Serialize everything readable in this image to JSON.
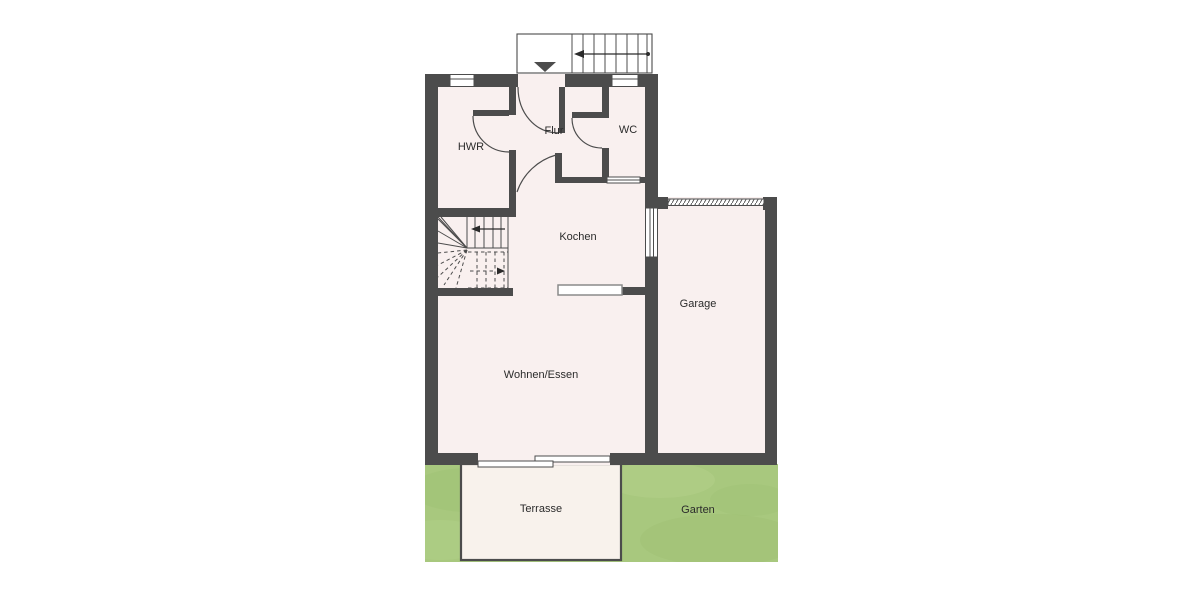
{
  "plan": {
    "type": "floor-plan",
    "colors": {
      "wall": "#4c4c4c",
      "floor": "#f9f0ef",
      "terrace": "#f8f2ec",
      "garden": "#a8c87e",
      "background": "#ffffff",
      "label_text": "#2b2b2b"
    },
    "rooms": [
      {
        "id": "hwr",
        "label": "HWR"
      },
      {
        "id": "flur",
        "label": "Flur"
      },
      {
        "id": "wc",
        "label": "WC"
      },
      {
        "id": "kochen",
        "label": "Kochen"
      },
      {
        "id": "garage",
        "label": "Garage"
      },
      {
        "id": "wohnen-essen",
        "label": "Wohnen/Essen"
      },
      {
        "id": "terrasse",
        "label": "Terrasse"
      },
      {
        "id": "garten",
        "label": "Garten"
      }
    ],
    "icons": [
      "entrance-arrow-icon",
      "exterior-stair-direction-arrow-icon",
      "stair-down-arrow-icon",
      "stair-up-arrow-icon"
    ]
  }
}
